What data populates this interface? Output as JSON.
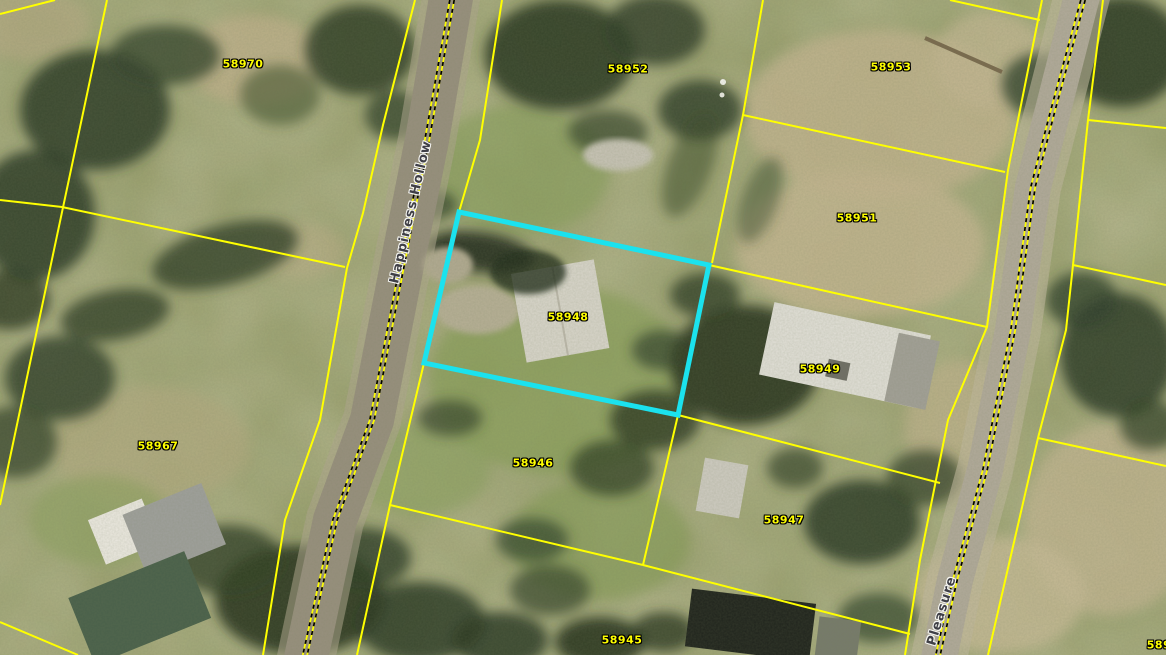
{
  "map": {
    "description": "aerial-parcel-map",
    "colors": {
      "parcel_line": "#ffff00",
      "parcel_label": "#ffff00",
      "selected_parcel_highlight": "#1be2ee",
      "street_label": "#3f3f46",
      "street_label_halo": "#f4f4f0"
    },
    "selected_parcel": "58948",
    "parcels": [
      {
        "id": "58970",
        "x": 243,
        "y": 64
      },
      {
        "id": "58952",
        "x": 628,
        "y": 69
      },
      {
        "id": "58953",
        "x": 891,
        "y": 67
      },
      {
        "id": "58951",
        "x": 857,
        "y": 218
      },
      {
        "id": "58948",
        "x": 568,
        "y": 317
      },
      {
        "id": "58949",
        "x": 820,
        "y": 369
      },
      {
        "id": "58967",
        "x": 158,
        "y": 446
      },
      {
        "id": "58946",
        "x": 533,
        "y": 463
      },
      {
        "id": "58947",
        "x": 784,
        "y": 520
      },
      {
        "id": "58945",
        "x": 622,
        "y": 640
      },
      {
        "id": "589",
        "x": 1159,
        "y": 645
      }
    ],
    "streets": [
      {
        "name": "Happiness Hollow",
        "x": 411,
        "y": 212,
        "angle": -77
      },
      {
        "name": "Pleasure",
        "x": 942,
        "y": 611,
        "angle": -73
      }
    ]
  }
}
